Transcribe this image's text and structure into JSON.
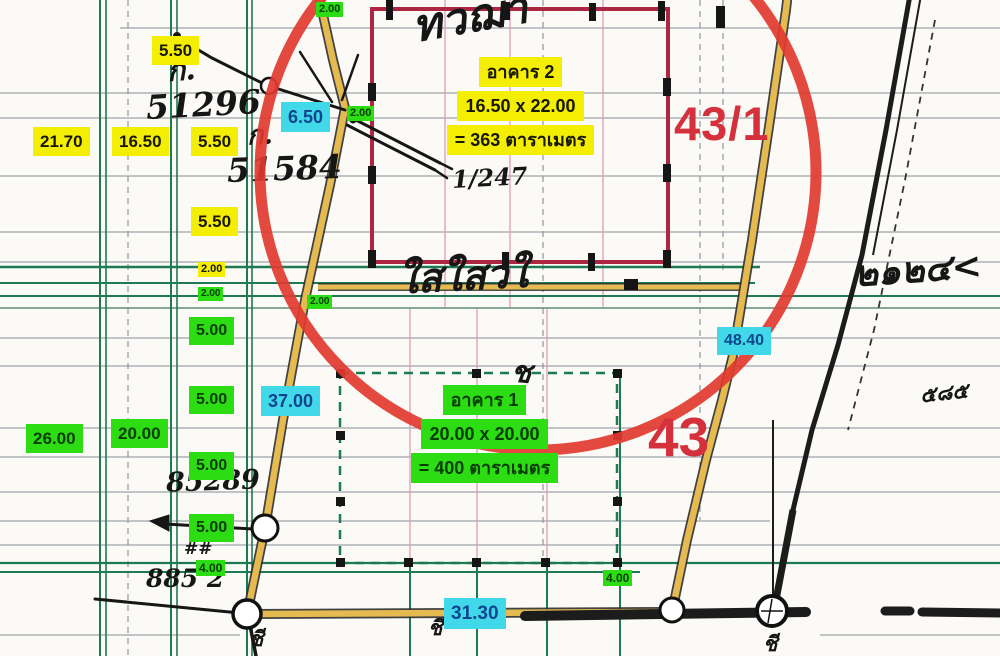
{
  "map": {
    "title_note": "scanned cadastral survey sketch",
    "parcels": {
      "main": "43",
      "sub": "43/1"
    },
    "building2": {
      "line1": "อาคาร 2",
      "line2": "16.50 x 22.00",
      "line3": "= 363 ตาราเมตร"
    },
    "building1": {
      "line1": "อาคาร 1",
      "line2": "20.00 x 20.00",
      "line3": "= 400 ตาราเมตร"
    },
    "labels": [
      {
        "text": "5.50",
        "type": "yellow",
        "x": 152,
        "y": 36,
        "fs": 17
      },
      {
        "text": "21.70",
        "type": "yellow",
        "x": 33,
        "y": 127,
        "fs": 17
      },
      {
        "text": "16.50",
        "type": "yellow",
        "x": 112,
        "y": 127,
        "fs": 17
      },
      {
        "text": "5.50",
        "type": "yellow",
        "x": 191,
        "y": 127,
        "fs": 17
      },
      {
        "text": "5.50",
        "type": "yellow",
        "x": 191,
        "y": 207,
        "fs": 17
      },
      {
        "text": "2.00",
        "type": "yellow",
        "x": 198,
        "y": 262,
        "fs": 11
      },
      {
        "text": "2.00",
        "type": "green",
        "x": 316,
        "y": 2,
        "fs": 11
      },
      {
        "text": "2.00",
        "type": "green",
        "x": 347,
        "y": 106,
        "fs": 11
      },
      {
        "text": "2.00",
        "type": "green",
        "x": 198,
        "y": 287,
        "fs": 10
      },
      {
        "text": "2.00",
        "type": "green",
        "x": 307,
        "y": 295,
        "fs": 10
      },
      {
        "text": "5.00",
        "type": "green",
        "x": 189,
        "y": 317,
        "fs": 16
      },
      {
        "text": "5.00",
        "type": "green",
        "x": 189,
        "y": 386,
        "fs": 16
      },
      {
        "text": "26.00",
        "type": "green",
        "x": 26,
        "y": 424,
        "fs": 17
      },
      {
        "text": "20.00",
        "type": "green",
        "x": 111,
        "y": 419,
        "fs": 17
      },
      {
        "text": "5.00",
        "type": "green",
        "x": 189,
        "y": 452,
        "fs": 16
      },
      {
        "text": "5.00",
        "type": "green",
        "x": 189,
        "y": 514,
        "fs": 16
      },
      {
        "text": "4.00",
        "type": "green",
        "x": 196,
        "y": 560,
        "fs": 12
      },
      {
        "text": "4.00",
        "type": "green",
        "x": 603,
        "y": 570,
        "fs": 12
      },
      {
        "text": "6.50",
        "type": "cyan",
        "x": 281,
        "y": 102,
        "fs": 18
      },
      {
        "text": "37.00",
        "type": "cyan",
        "x": 261,
        "y": 386,
        "fs": 18
      },
      {
        "text": "48.40",
        "type": "cyan",
        "x": 717,
        "y": 327,
        "fs": 16
      },
      {
        "text": "31.30",
        "type": "cyan",
        "x": 444,
        "y": 598,
        "fs": 19
      }
    ],
    "handwriting": [
      {
        "text": "ก.",
        "x": 167,
        "y": 56,
        "fs": 30,
        "rot": -4
      },
      {
        "text": "51296",
        "x": 146,
        "y": 88,
        "fs": 33,
        "rot": -3
      },
      {
        "text": "ก.",
        "x": 247,
        "y": 122,
        "fs": 27,
        "rot": -2
      },
      {
        "text": "51584",
        "x": 227,
        "y": 152,
        "fs": 33,
        "rot": -2
      },
      {
        "text": "ทวฌา",
        "x": 412,
        "y": -4,
        "fs": 44,
        "rot": -10
      },
      {
        "text": "1/247",
        "x": 452,
        "y": 166,
        "fs": 24,
        "rot": -3
      },
      {
        "text": "ใสใสวใ",
        "x": 398,
        "y": 257,
        "fs": 40,
        "rot": -3
      },
      {
        "text": "๒๑๒๔<",
        "x": 854,
        "y": 252,
        "fs": 36,
        "rot": -4
      },
      {
        "text": "85289",
        "x": 166,
        "y": 468,
        "fs": 27,
        "rot": -2
      },
      {
        "text": "##",
        "x": 184,
        "y": 541,
        "fs": 17,
        "rot": 0
      },
      {
        "text": "885 2",
        "x": 146,
        "y": 566,
        "fs": 25,
        "rot": 0
      },
      {
        "text": "ช",
        "x": 511,
        "y": 358,
        "fs": 30,
        "rot": 5
      },
      {
        "text": "ชี",
        "x": 249,
        "y": 628,
        "fs": 21,
        "rot": 0
      },
      {
        "text": "ชี",
        "x": 428,
        "y": 617,
        "fs": 21,
        "rot": 0
      },
      {
        "text": "ชี",
        "x": 763,
        "y": 633,
        "fs": 21,
        "rot": 0
      },
      {
        "text": "๕๘๕",
        "x": 920,
        "y": 382,
        "fs": 21,
        "rot": -6
      }
    ],
    "colors": {
      "label_yellow": "#f4ed04",
      "label_green": "#2cdd14",
      "label_cyan": "#41d9e9",
      "cyan_text": "#0f458e",
      "parcel_red": "#d5313d",
      "emphasis_circle_red": "#e23a30",
      "building2_outline_red": "#ae2742",
      "road_yellow": "#e5ba51",
      "survey_grid_green": "#1e7a52"
    }
  }
}
